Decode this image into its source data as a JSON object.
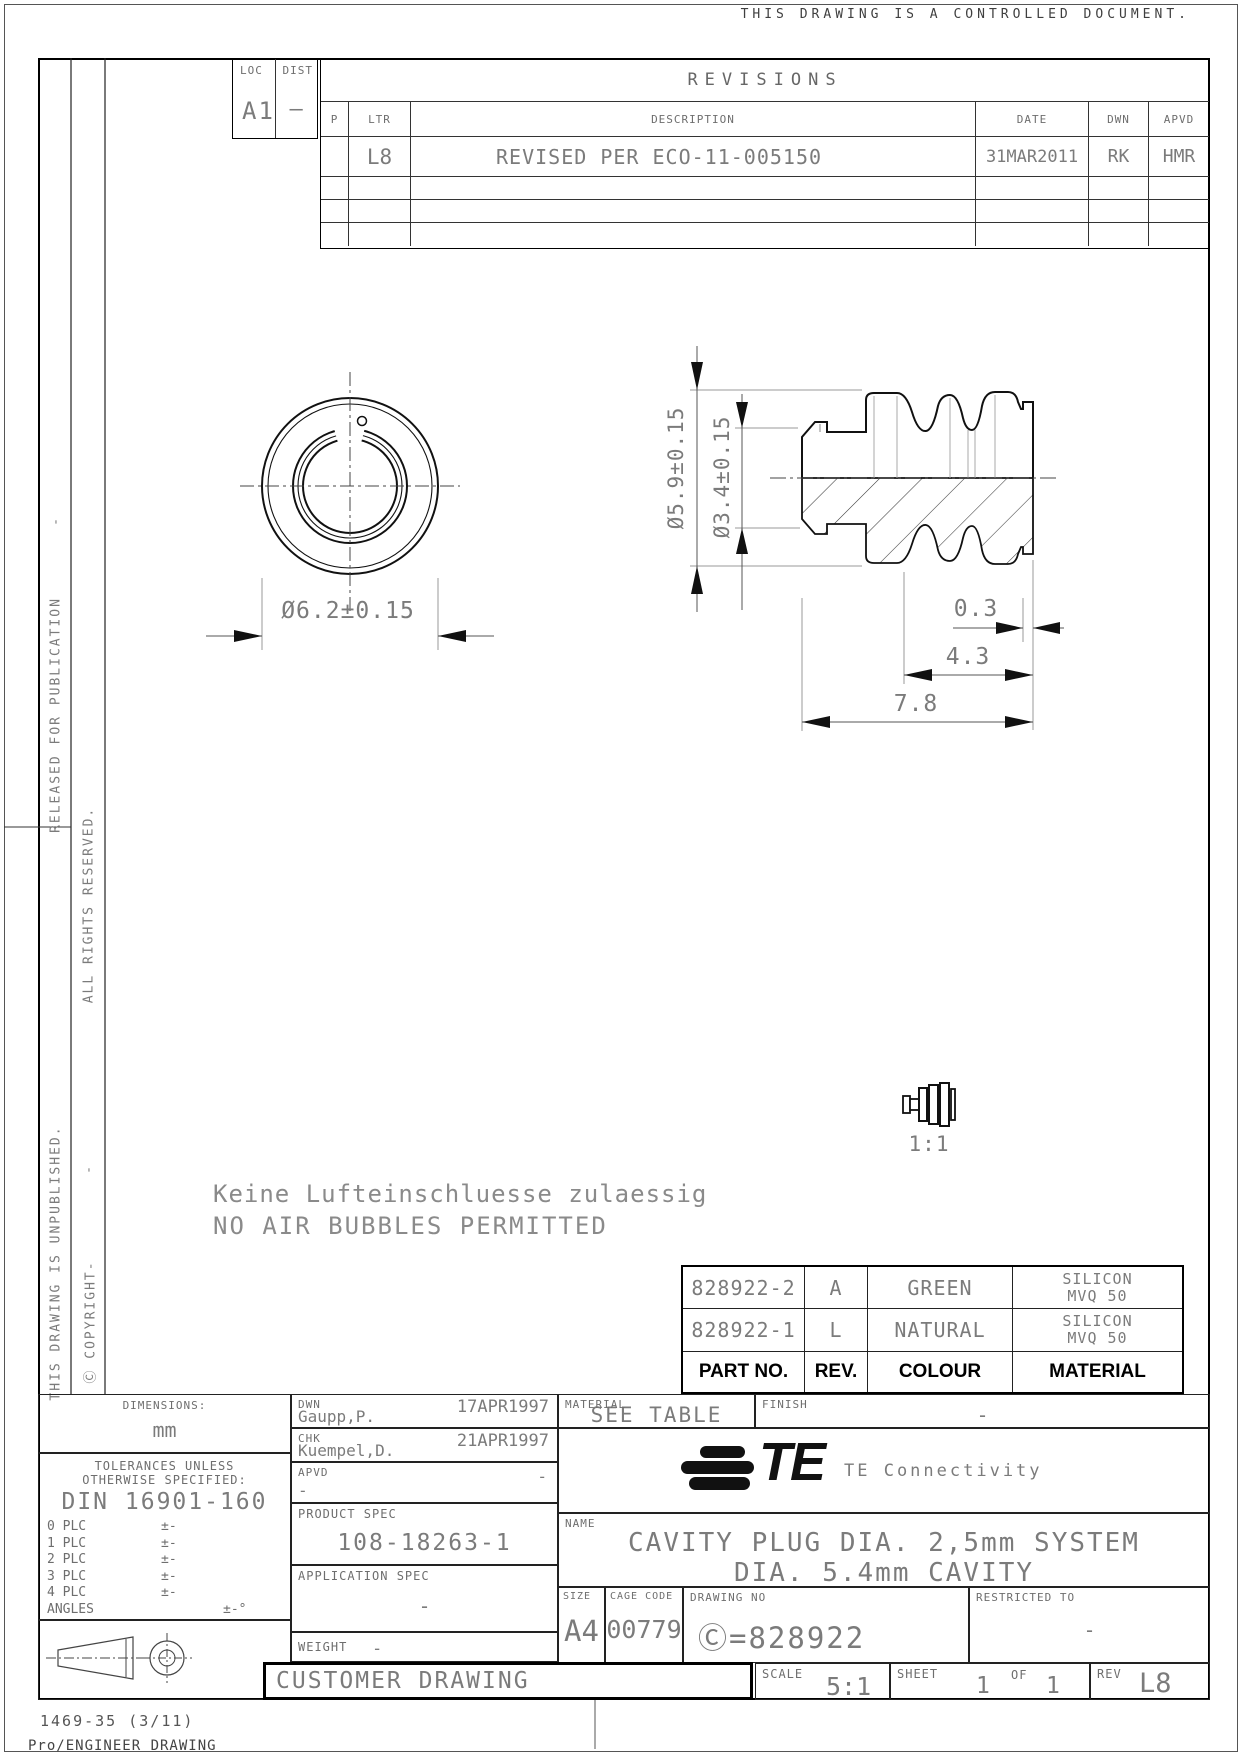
{
  "page": {
    "controlled_note": "THIS DRAWING IS A CONTROLLED DOCUMENT.",
    "form_number": "1469-35 (3/11)",
    "footer_note": "Pro/ENGINEER DRAWING"
  },
  "side_notes": {
    "released": "RELEASED FOR PUBLICATION",
    "dash_top": "-",
    "unpublished": "THIS DRAWING IS UNPUBLISHED.",
    "rights": "ALL RIGHTS RESERVED.",
    "dash_bottom": "-",
    "copyright": "Ⓒ COPYRIGHT-"
  },
  "revisions": {
    "loc_label": "LOC",
    "loc_value": "A1",
    "dist_label": "DIST",
    "dist_value": "–",
    "title": "REVISIONS",
    "headers": {
      "p": "P",
      "ltr": "LTR",
      "description": "DESCRIPTION",
      "date": "DATE",
      "dwn": "DWN",
      "apvd": "APVD"
    },
    "row": {
      "ltr": "L8",
      "description": "REVISED PER ECO-11-005150",
      "date": "31MAR2011",
      "dwn": "RK",
      "apvd": "HMR"
    }
  },
  "drawing": {
    "dim_front_diameter": "Ø6.2±0.15",
    "dim_side_outer": "Ø5.9±0.15",
    "dim_side_inner": "Ø3.4±0.15",
    "dim_lip": "0.3",
    "dim_body": "4.3",
    "dim_total": "7.8",
    "scale_view_label": "1:1",
    "note_line1": "Keine Lufteinschluesse zulaessig",
    "note_line2": "NO AIR BUBBLES PERMITTED"
  },
  "part_table": {
    "headers": {
      "part_no": "PART NO.",
      "rev": "REV.",
      "colour": "COLOUR",
      "material": "MATERIAL"
    },
    "rows": [
      {
        "part_no": "828922-2",
        "rev": "A",
        "colour": "GREEN",
        "material_line1": "SILICON",
        "material_line2": "MVQ 50"
      },
      {
        "part_no": "828922-1",
        "rev": "L",
        "colour": "NATURAL",
        "material_line1": "SILICON",
        "material_line2": "MVQ 50"
      }
    ]
  },
  "title_block": {
    "dimensions_label": "DIMENSIONS:",
    "dimensions_value": "mm",
    "tolerances_line1": "TOLERANCES UNLESS",
    "tolerances_line2": "OTHERWISE SPECIFIED:",
    "tolerances_standard": "DIN 16901-160",
    "plc": [
      {
        "label": "0 PLC",
        "value": "±-"
      },
      {
        "label": "1 PLC",
        "value": "±-"
      },
      {
        "label": "2 PLC",
        "value": "±-"
      },
      {
        "label": "3 PLC",
        "value": "±-"
      },
      {
        "label": "4 PLC",
        "value": "±-"
      },
      {
        "label": "ANGLES",
        "value": "±-°"
      }
    ],
    "dwn_label": "DWN",
    "dwn_name": "Gaupp,P.",
    "dwn_date": "17APR1997",
    "chk_label": "CHK",
    "chk_name": "Kuempel,D.",
    "chk_date": "21APR1997",
    "apvd_label": "APVD",
    "apvd_date": "-",
    "apvd_name": "-",
    "product_spec_label": "PRODUCT SPEC",
    "product_spec_value": "108-18263-1",
    "application_spec_label": "APPLICATION SPEC",
    "application_spec_value": "-",
    "weight_label": "WEIGHT",
    "weight_value": "-",
    "customer_drawing_label": "CUSTOMER DRAWING",
    "material_label": "MATERIAL",
    "material_value": "SEE TABLE",
    "finish_label": "FINISH",
    "finish_value": "-",
    "brand_logo_text": "TE",
    "brand_name": "TE Connectivity",
    "name_label": "NAME",
    "name_line1": "CAVITY PLUG DIA. 2,5mm SYSTEM",
    "name_line2": "DIA. 5.4mm CAVITY",
    "size_label": "SIZE",
    "size_value": "A4",
    "cage_label": "CAGE CODE",
    "cage_value": "00779",
    "drawing_no_label": "DRAWING NO",
    "drawing_no_value": "Ⓒ=828922",
    "restricted_label": "RESTRICTED TO",
    "restricted_value": "-",
    "scale_label": "SCALE",
    "scale_value": "5:1",
    "sheet_label": "SHEET",
    "sheet_value": "1",
    "sheet_of_label": "OF",
    "sheet_total": "1",
    "rev_label": "REV",
    "rev_value": "L8"
  }
}
